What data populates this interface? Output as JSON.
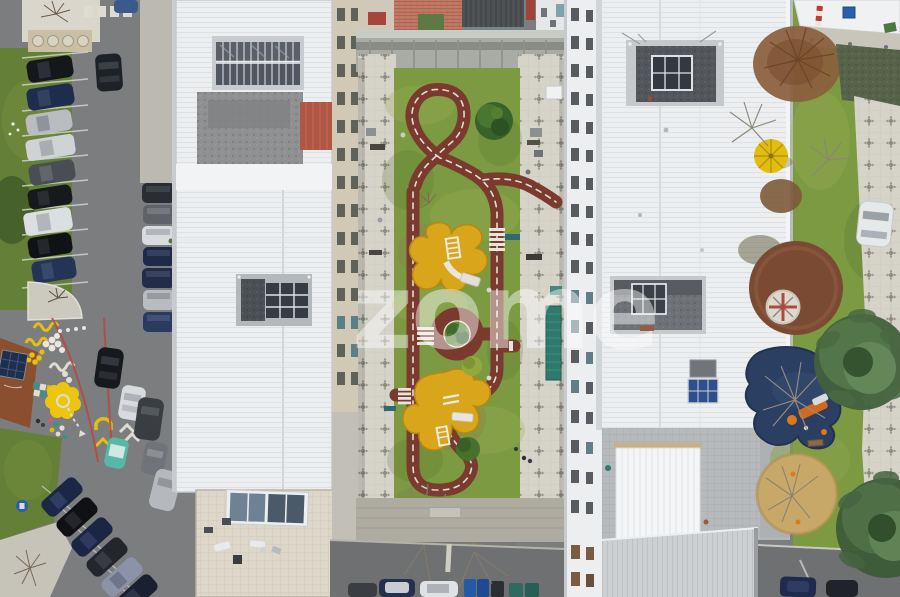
{
  "scene": {
    "type": "aerial-drone-photograph",
    "description": "Top-down aerial view of residential apartment blocks with a children's traffic-training garden (red looping track, roundabout, yellow play areas) in the central courtyard, street parking on the left, playground and trees on the right",
    "watermark": "zome"
  },
  "palette": {
    "asphalt": "#7b7d7f",
    "asphalt-dark": "#6e7072",
    "grass": "#7b9a42",
    "grass-dark": "#647f36",
    "roof-white": "#eceef0",
    "roof-gray-tile": "#b7babc",
    "track": "#7a3a2d",
    "play-yellow": "#d9a51a",
    "walkway": "#d6d3c9",
    "terrace": "#dcd7c8",
    "sand": "#c8a868",
    "playground-blue": "#2b3f63",
    "playground-brown": "#7a4a33",
    "street-art-yellow": "#e6bf0f",
    "umbrella-yellow": "#e3bd0e",
    "terracotta": "#c27b66",
    "rust-roof": "#8a4f2e",
    "conifer": "#42603c",
    "red-line": "#b8473e",
    "watermark-color": "#ffffff"
  }
}
